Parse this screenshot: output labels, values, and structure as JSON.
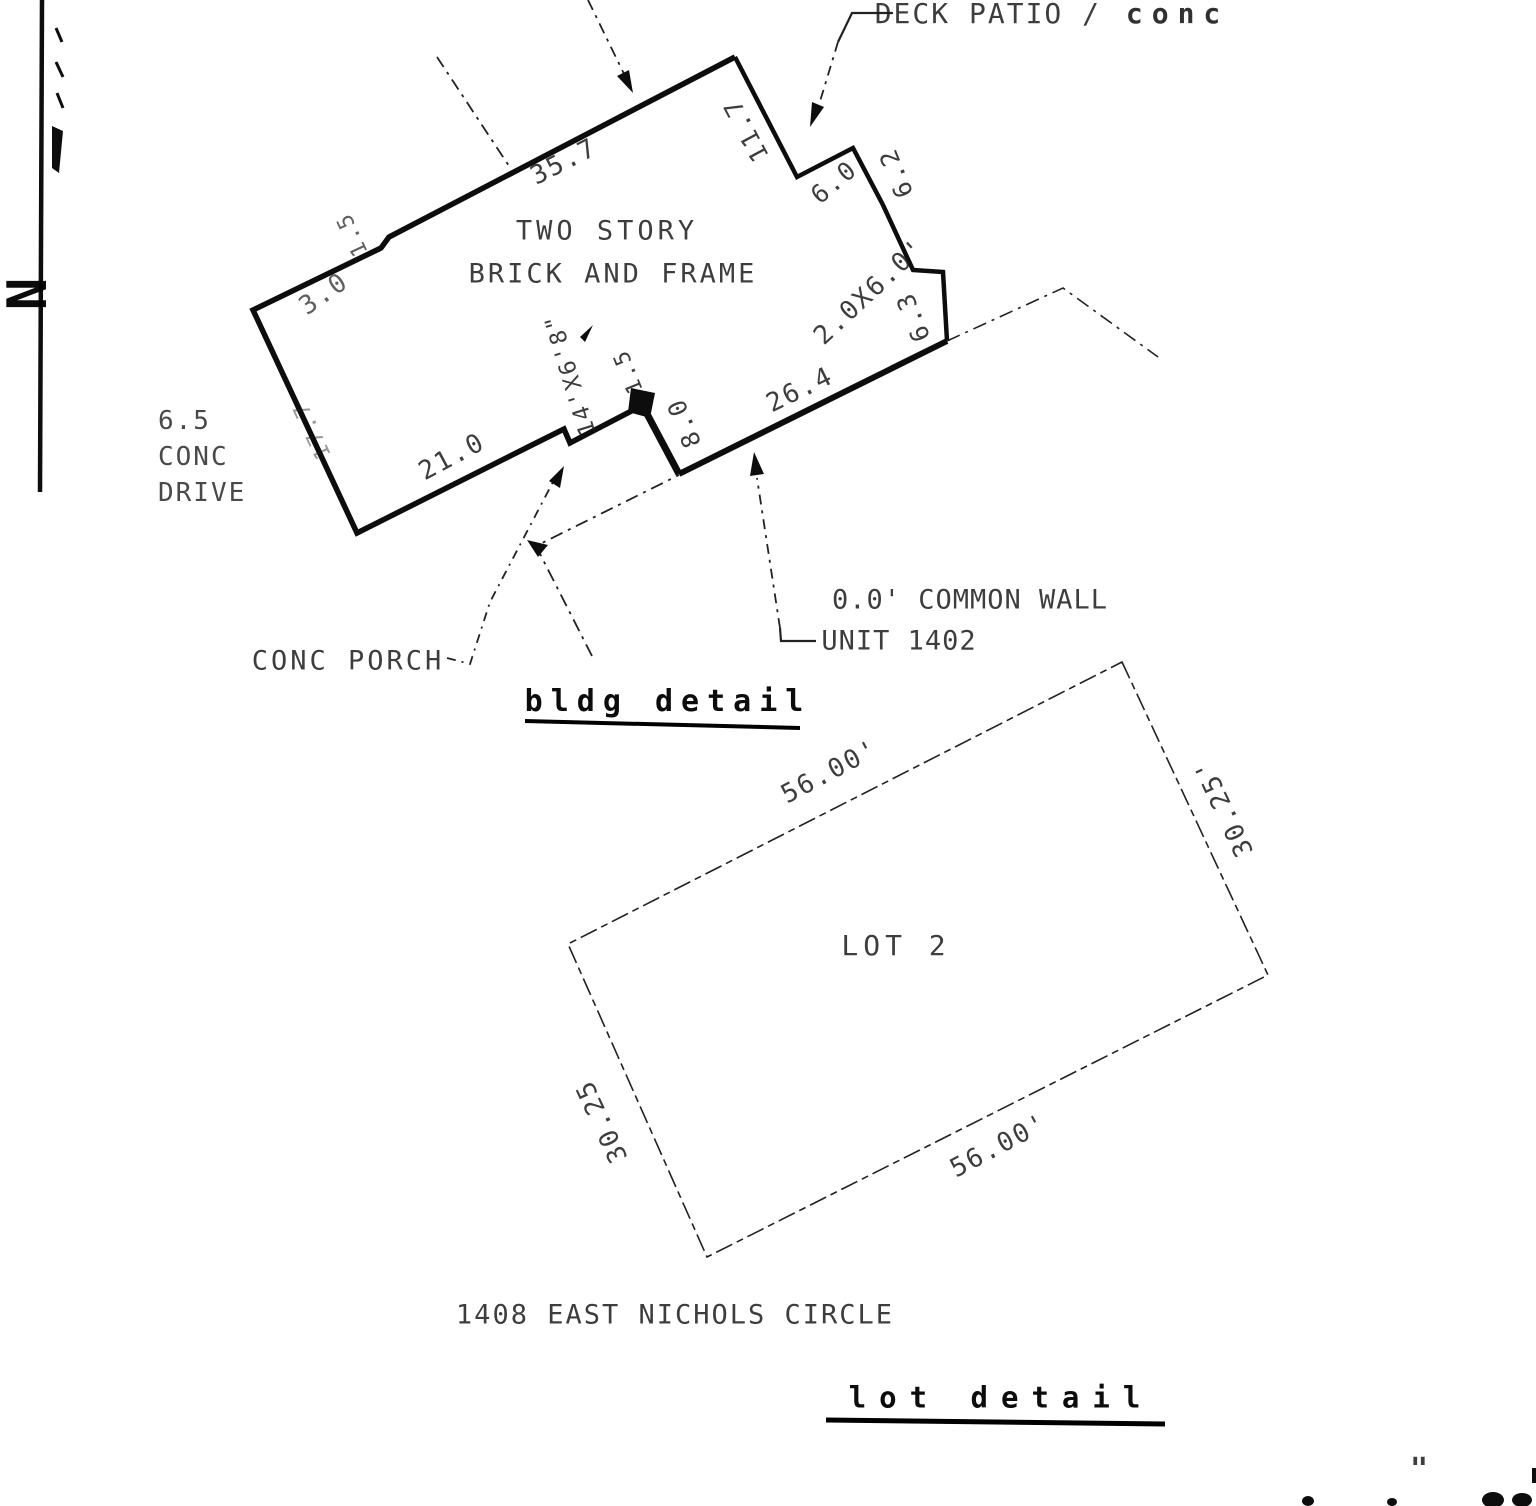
{
  "drawing": {
    "north_label": "N",
    "bldg": {
      "title": "bldg detail",
      "building_line1": "TWO STORY",
      "building_line2": "BRICK AND FRAME",
      "deck_patio": "DECK PATIO /",
      "deck_patio_hand": "conc",
      "drive_1": "6.5",
      "drive_2": "CONC",
      "drive_3": "DRIVE",
      "conc_porch": "CONC PORCH",
      "common_wall_1": "0.0' COMMON WALL",
      "common_wall_2": "UNIT 1402",
      "dim_top": "35.7",
      "dim_notch_small": "1.5",
      "dim_notch": "3.0",
      "dim_left": "17.7",
      "dim_bottom_left": "21.0",
      "dim_right_upper": "11.7",
      "dim_step_a": "6.0",
      "dim_step_b": "6.2",
      "dim_bay": "2.0X6.0'",
      "dim_bay_side": "6.3",
      "dim_bottom_right": "26.4",
      "dim_common_wall": "8.0",
      "dim_porch_step": "1.5",
      "dim_porch": "14'X6'8\""
    },
    "lot": {
      "title": "lot detail",
      "lot_label": "LOT 2",
      "address": "1408 EAST NICHOLS CIRCLE",
      "dim_ne": "56.00'",
      "dim_se": "30.25'",
      "dim_sw": "56.00'",
      "dim_nw": "30.25"
    },
    "fragments": {
      "corner_quote": "\""
    }
  }
}
